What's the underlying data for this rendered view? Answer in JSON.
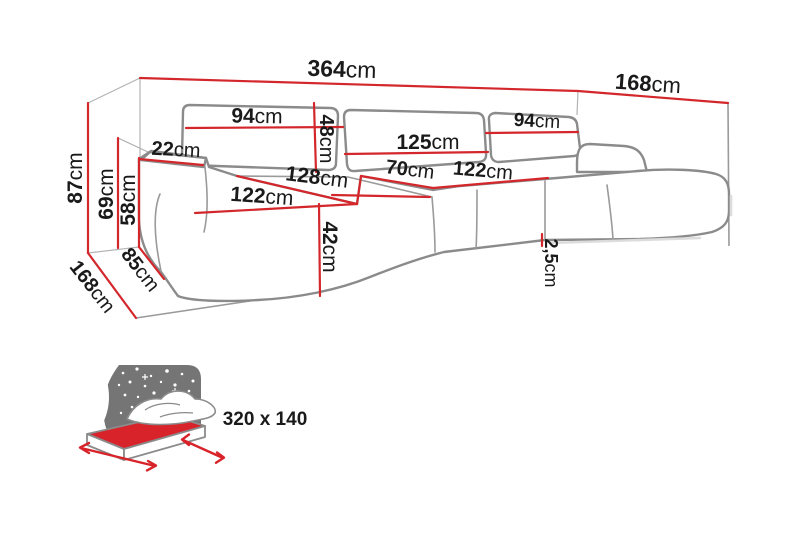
{
  "diagram": {
    "title": "corner-sofa-dimension-diagram",
    "dimensions": {
      "total_width": {
        "value": "364",
        "unit": "cm"
      },
      "depth_right": {
        "value": "168",
        "unit": "cm"
      },
      "total_height": {
        "value": "87",
        "unit": "cm"
      },
      "back_height": {
        "value": "69",
        "unit": "cm"
      },
      "armrest_height": {
        "value": "58",
        "unit": "cm"
      },
      "armrest_width": {
        "value": "22",
        "unit": "cm"
      },
      "back_cushion_left": {
        "value": "94",
        "unit": "cm"
      },
      "back_cushion_height": {
        "value": "48",
        "unit": "cm"
      },
      "back_cushion_middle": {
        "value": "125",
        "unit": "cm"
      },
      "back_cushion_right": {
        "value": "94",
        "unit": "cm"
      },
      "inner_seat_width": {
        "value": "128",
        "unit": "cm"
      },
      "seat_depth": {
        "value": "70",
        "unit": "cm"
      },
      "right_seat_width": {
        "value": "122",
        "unit": "cm"
      },
      "chaise_length": {
        "value": "122",
        "unit": "cm"
      },
      "seat_height": {
        "value": "42",
        "unit": "cm"
      },
      "depth_left": {
        "value": "168",
        "unit": "cm"
      },
      "side_depth": {
        "value": "85",
        "unit": "cm"
      },
      "floor_clearance": {
        "value": "2,5",
        "unit": "cm"
      }
    },
    "colors": {
      "dimension_line": "#d3272c",
      "sofa_outline": "#8b8b8b",
      "label_text": "#1a1a1a",
      "icon_gray": "#757575",
      "icon_red": "#d8232a"
    }
  },
  "sleep_function": {
    "bed_size": "320 x 140"
  }
}
